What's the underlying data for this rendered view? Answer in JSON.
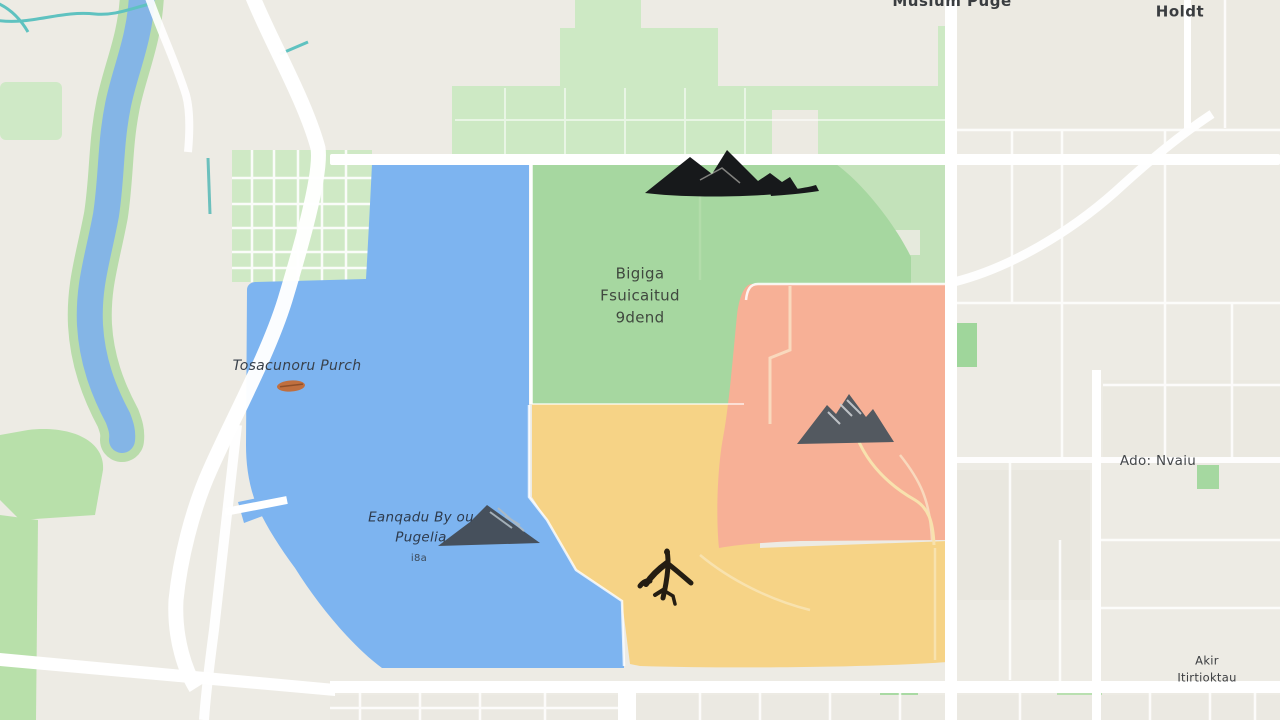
{
  "map": {
    "base": {
      "background": "#edebe4",
      "road_color": "#ffffff",
      "river_color": "#84b5e6",
      "river_bank_color": "#b9dcab",
      "stream_color": "#5fc2c0",
      "park_color": "#cde9c4",
      "block_color": "#e9e7e0"
    },
    "regions": {
      "blue": {
        "name": "blue-district",
        "color": "#7db4f0"
      },
      "green": {
        "name": "green-district",
        "color": "#a6d7a0"
      },
      "salmon": {
        "name": "salmon-district",
        "color": "#f7b096"
      },
      "yellow": {
        "name": "yellow-district",
        "color": "#f6d386"
      }
    },
    "labels": {
      "green_park": {
        "text": "Bigiga\nFsuicaitud\n9dend"
      },
      "blue_left": {
        "text": "Tosacunoru Purch"
      },
      "blue_lower": {
        "text": "Eanqadu By ou\nPugelia",
        "subtext": "i8a"
      },
      "right_area": {
        "text": "Ado: Nvaiu"
      },
      "top_center": {
        "text": "Musium Puge"
      },
      "top_right": {
        "text": "Meattti Holdt"
      },
      "bottom_right": {
        "text": "Akir Itirtioktau"
      }
    },
    "icons": {
      "mountain_range_top": {
        "name": "mountain-range-icon",
        "color": "#17191b"
      },
      "mountain_peak_salmon": {
        "name": "mountain-peak-icon",
        "color": "#535960",
        "streak": "#c9cdd0"
      },
      "mountain_peak_blue": {
        "name": "mountain-small-icon",
        "color": "#46505c",
        "streak": "#aebac3"
      },
      "airplane": {
        "name": "airplane-icon",
        "color": "#241d12"
      },
      "orange_marker": {
        "name": "orange-marker-icon",
        "color": "#c06f3f"
      }
    }
  }
}
